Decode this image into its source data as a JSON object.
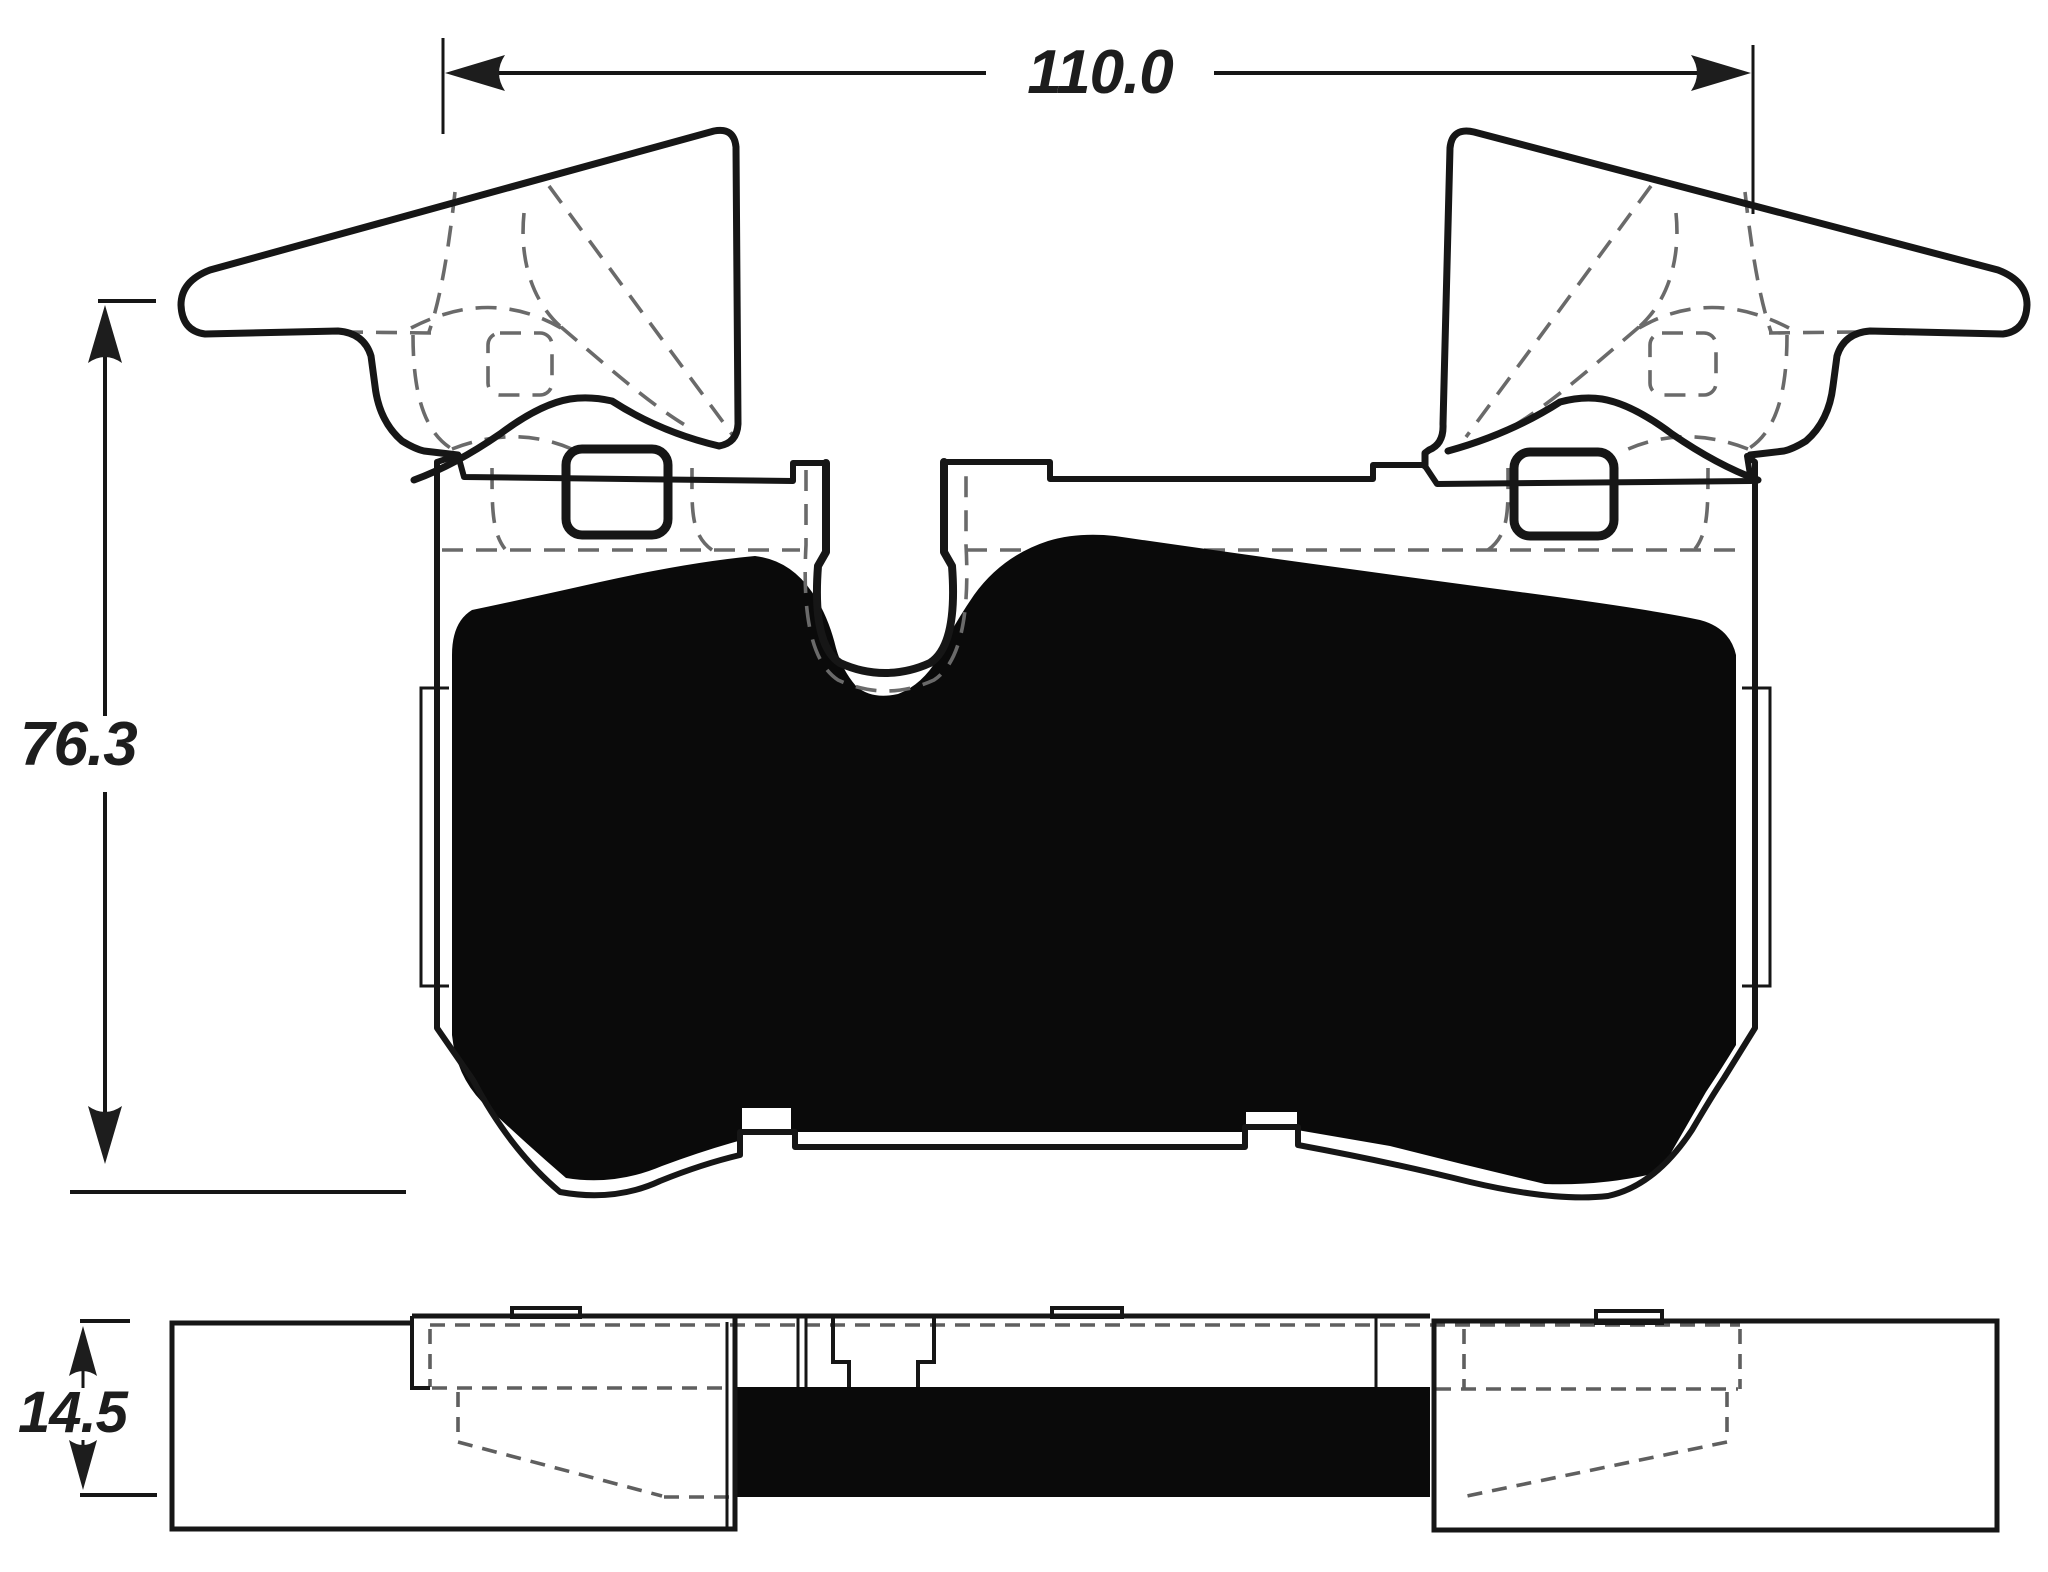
{
  "diagram": {
    "type": "brake-pad-dimensional-drawing",
    "views": {
      "front_view": "pad-front-profile",
      "side_view": "pad-edge-profile"
    },
    "dimensions": {
      "width": {
        "label": "110.0"
      },
      "height": {
        "label": "76.3"
      },
      "thickness": {
        "label": "14.5"
      }
    },
    "colors": {
      "line": "#161616",
      "hidden_line": "#6a6a6a",
      "friction_fill": "#0a0a0a",
      "background": "#ffffff",
      "label_text": "#1d1d1d"
    }
  }
}
